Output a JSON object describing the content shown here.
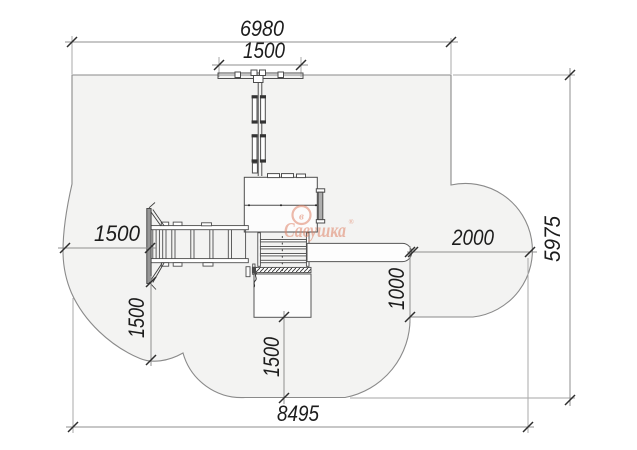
{
  "dimensions": {
    "zone_top_width": "6980",
    "swing_beam_width": "1500",
    "left_clearance": "1500",
    "slide_clearance": "2000",
    "slide_side_clearance": "1000",
    "zone_height": "5975",
    "left_bottom_clearance": "1500",
    "tower_bottom_clearance": "1500",
    "zone_total_width": "8495"
  },
  "watermark": {
    "brand": "Савушка",
    "registered": "®",
    "emblem": "в"
  }
}
